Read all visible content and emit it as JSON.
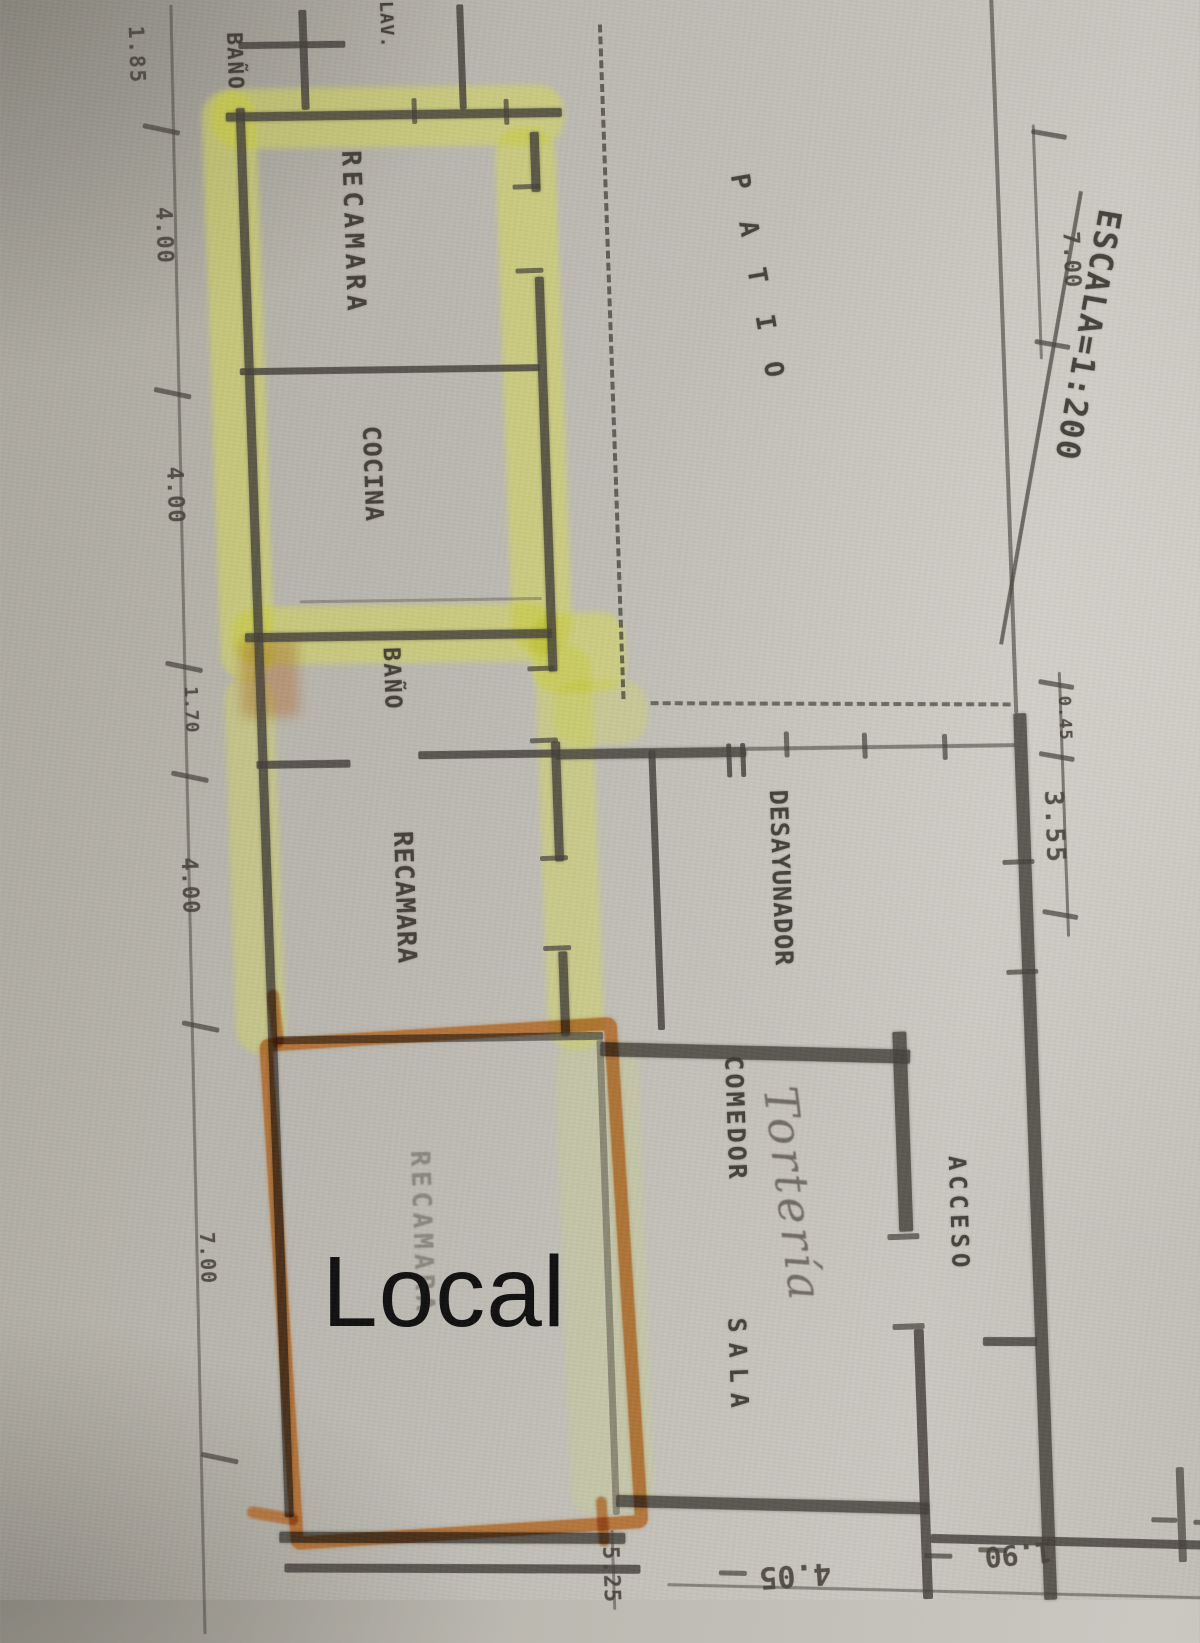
{
  "scale_title": "ESCALA=1:200",
  "rooms": {
    "bano_top": "BAÑO",
    "lav": "LAV.",
    "recamara_1": "RECAMARA",
    "cocina": "COCINA",
    "bano_2": "BAÑO",
    "recamara_2": "RECAMARA",
    "recamara_3": "RECAMARA",
    "patio": "PATIO",
    "desayunador": "DESAYUNADOR",
    "comedor": "COMEDOR",
    "sala": "SALA",
    "acceso": "ACCESO"
  },
  "dimensions": {
    "left": [
      "1.85",
      "4.00",
      "4.00",
      "1.70",
      "4.00",
      "7.00"
    ],
    "right": [
      "7.00",
      "0.45",
      "3.55"
    ],
    "bottom": [
      "5.25",
      "4.05",
      "1.90"
    ]
  },
  "annotations": {
    "local": "Local",
    "handwritten": "Tortería"
  },
  "colors": {
    "pencil": "#44403a",
    "highlighter": "#d9dc50",
    "marker": "#b05a18",
    "paper": "#bdbab2"
  }
}
